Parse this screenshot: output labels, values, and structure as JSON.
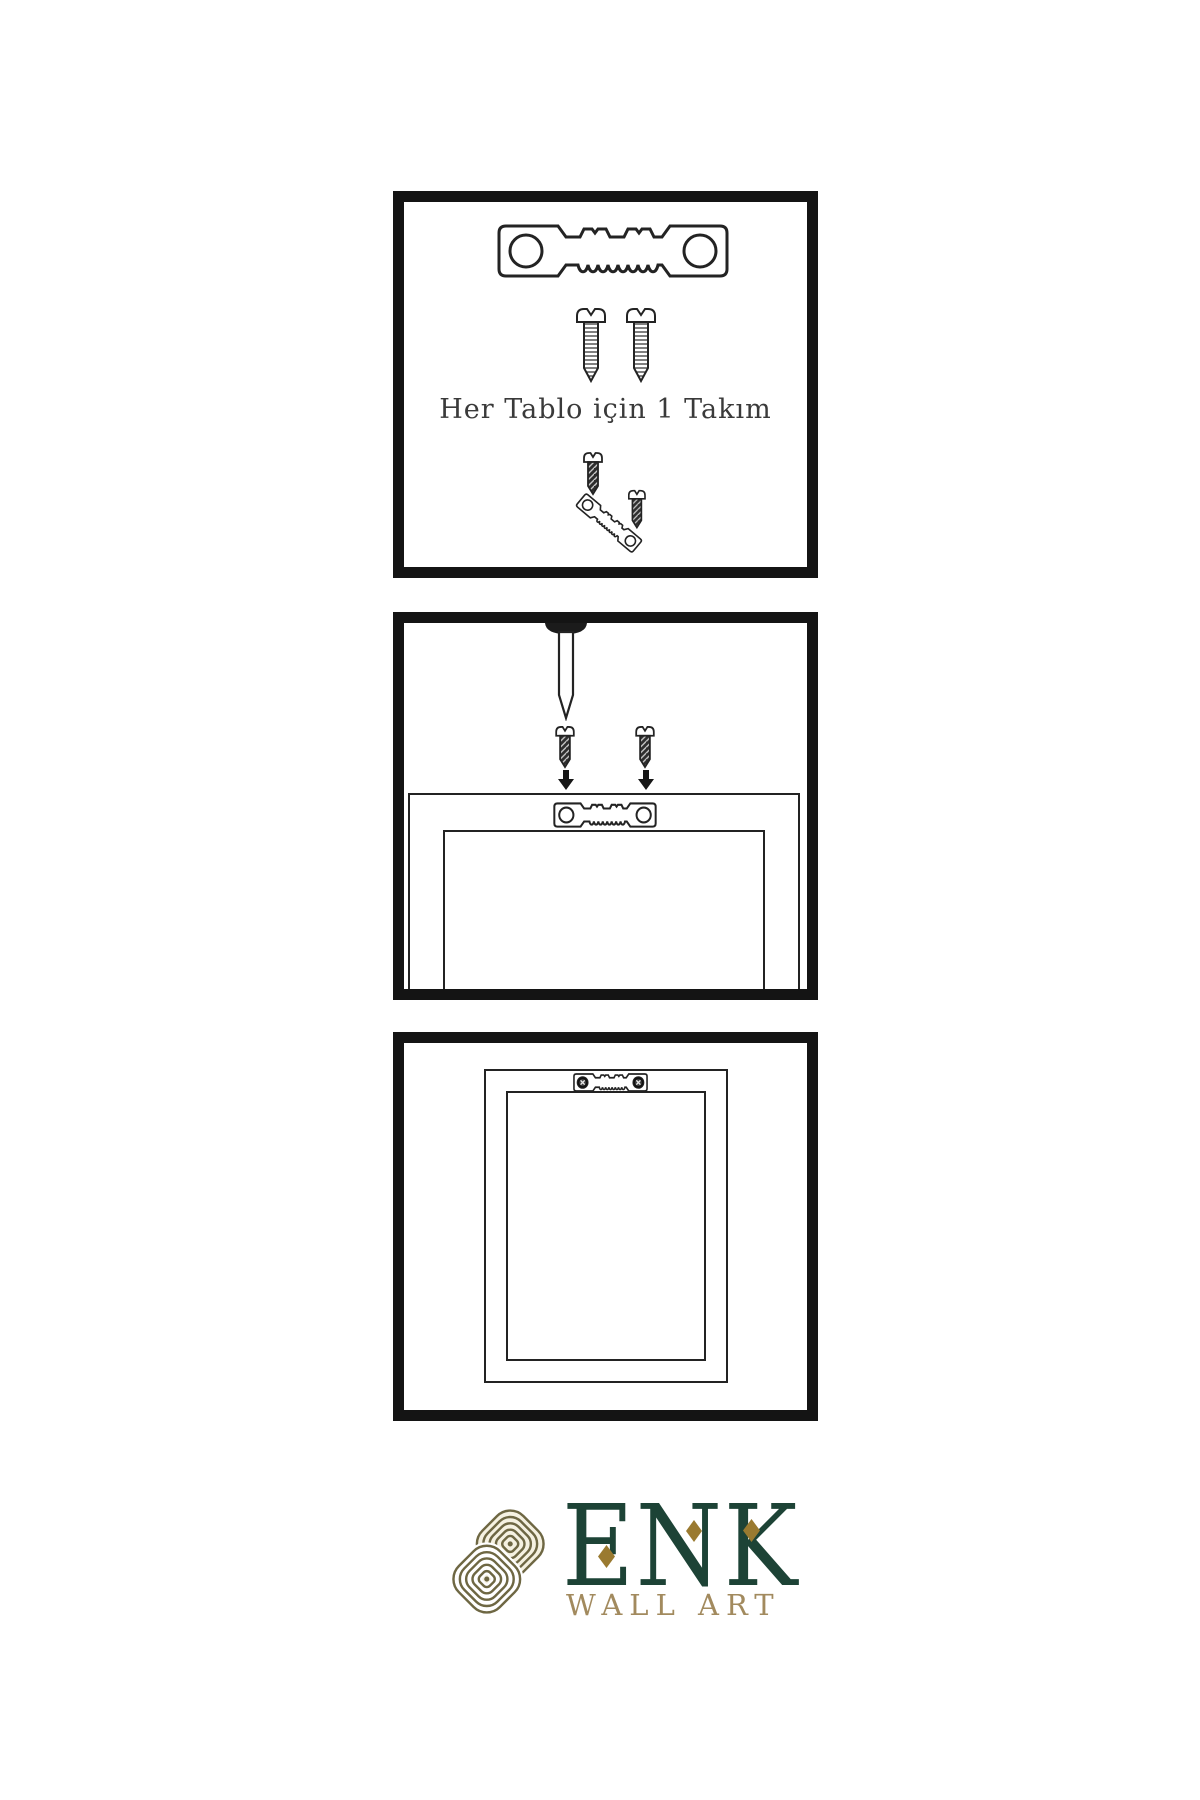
{
  "page": {
    "width": 1200,
    "height": 1800,
    "background": "#ffffff"
  },
  "panels": [
    {
      "name": "step-1-hardware-kit",
      "caption": "Her Tablo için 1 Takım",
      "icons": [
        "sawtooth-hanger-icon",
        "screw-icon",
        "screw-icon",
        "screw-icon",
        "angled-sawtooth-hanger-icon",
        "screw-icon"
      ]
    },
    {
      "name": "step-2-attach-hanger",
      "caption": "",
      "icons": [
        "wall-nail-icon",
        "dark-screw-icon",
        "dark-screw-icon",
        "down-arrow-icon",
        "down-arrow-icon",
        "frame-back-icon",
        "sawtooth-hanger-icon"
      ]
    },
    {
      "name": "step-3-hanger-mounted",
      "caption": "",
      "icons": [
        "frame-back-icon",
        "mounted-sawtooth-hanger-icon"
      ]
    }
  ],
  "logo": {
    "brand": "ENK",
    "tagline": "WALL ART"
  },
  "colors": {
    "line": "#232323",
    "dark_fill": "#2e2e2e",
    "nail_head": "#1b1b1b",
    "arrow": "#161616",
    "logo_green": "#1d4336",
    "diamond_gold": "#9a7a30",
    "knot_gold": "#6e6743",
    "knot_cream": "#f5f1e1",
    "tagline_gold": "#a28a5e"
  }
}
